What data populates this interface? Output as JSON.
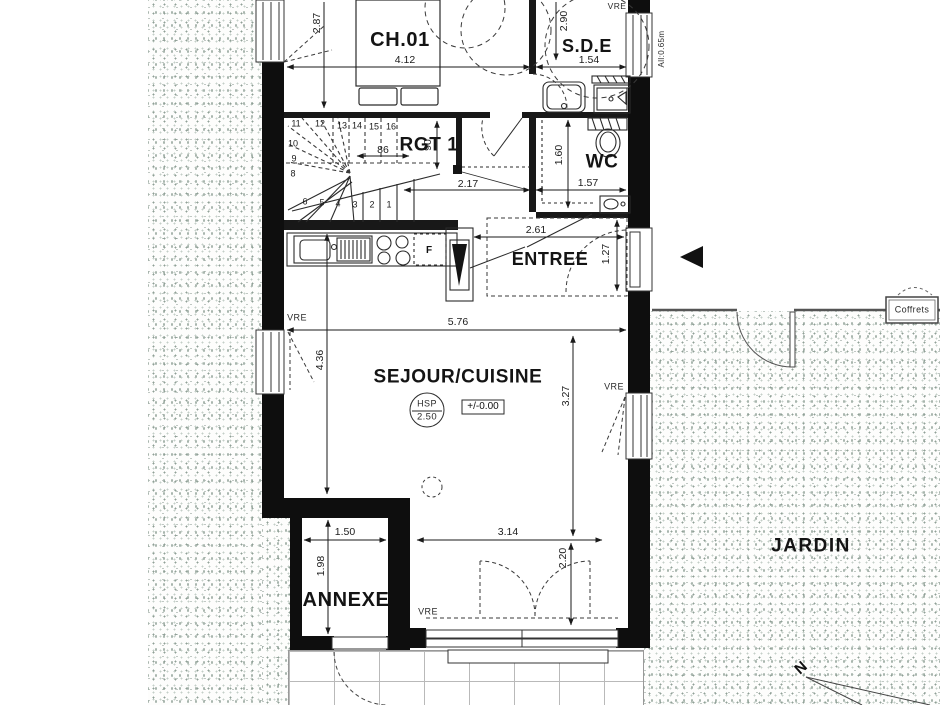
{
  "plan": {
    "rooms": {
      "ch01": "CH.01",
      "sde": "S.D.E",
      "rgt1": "RGT 1",
      "wc": "WC",
      "entree": "ENTREE",
      "sejour": "SEJOUR/CUISINE",
      "annexe": "ANNEXE",
      "jardin": "JARDIN"
    },
    "annotations": {
      "vre": "VRE",
      "allege": "All:0.65m",
      "coffrets": "Coffrets",
      "hsp": "HSP",
      "hsp_value": "2.50",
      "level": "+/-0.00",
      "fridge": "F",
      "north": "N"
    },
    "dimensions": {
      "ch01_w": "4.12",
      "ch01_h": "2.87",
      "sde_w": "1.54",
      "sde_h": "2.90",
      "stair_w": "86",
      "stair_d": "90",
      "hall_w": "2.17",
      "wc_w": "1.57",
      "wc_h": "1.60",
      "entree_w": "2.61",
      "entree_d": "1.27",
      "sejour_w": "5.76",
      "sejour_hl": "4.36",
      "sejour_hr": "3.27",
      "annexe_w": "1.50",
      "annexe_h": "1.98",
      "bay_w": "3.14",
      "bay_d": "2.20"
    },
    "stairs": {
      "steps": [
        "1",
        "2",
        "3",
        "4",
        "5",
        "6",
        "8",
        "9",
        "10",
        "11",
        "12",
        "13",
        "14",
        "15",
        "16"
      ]
    },
    "colors": {
      "wall": "#0e0e0e",
      "line": "#2b2b2b",
      "stipple": "#93a29a"
    }
  }
}
